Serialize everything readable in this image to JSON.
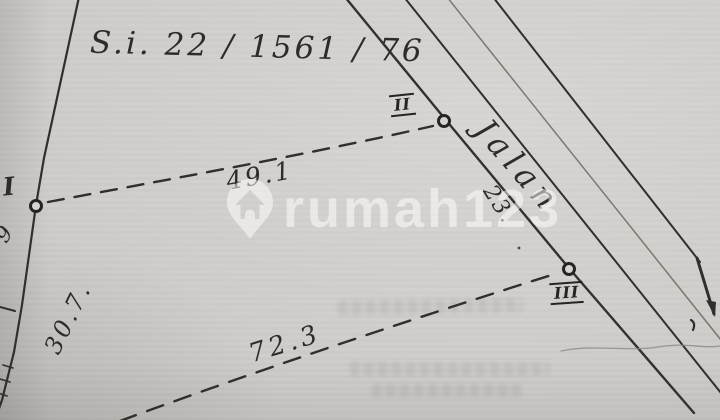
{
  "palette": {
    "paper": "#cdcac7",
    "ink": "#2e2b29",
    "ink_faint": "#6b6864",
    "watermark_white": "rgba(255,255,255,0.52)"
  },
  "header": {
    "reference_number": "S.i. 22  / 1561 / 76"
  },
  "road": {
    "label": "Jalan"
  },
  "survey_points": [
    {
      "id": "I"
    },
    {
      "id": "II"
    },
    {
      "id": "III"
    }
  ],
  "measurements": {
    "i_to_ii": "49.1",
    "ii_to_iii": "23.",
    "left_boundary": "30.7.",
    "bottom_to_iii": "72.3",
    "partial_left_edge": "9"
  },
  "watermark": {
    "brand": "rumah123",
    "logo": "map-pin-house"
  }
}
